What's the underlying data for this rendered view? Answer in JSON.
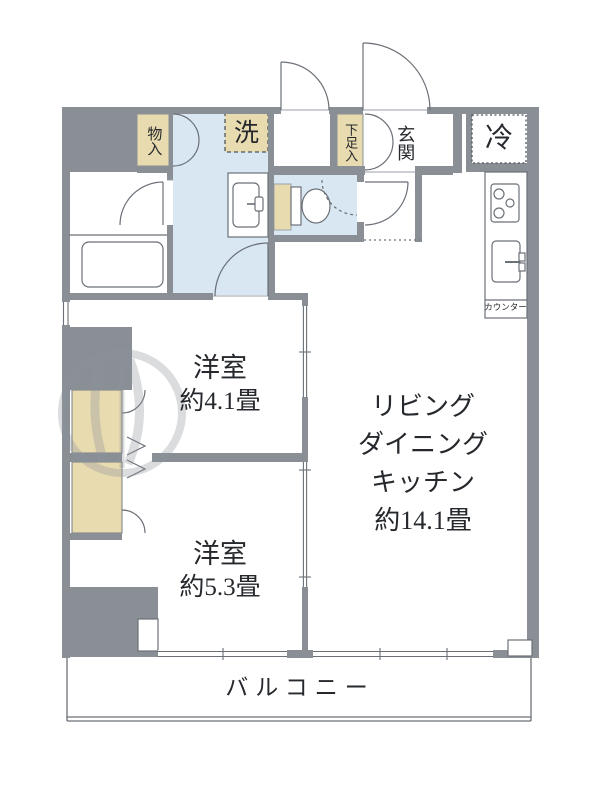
{
  "plan_title": "2LDK apartment floor plan",
  "rooms": {
    "ldk": {
      "line1": "リビング",
      "line2": "ダイニング",
      "line3": "キッチン",
      "size": "約14.1畳"
    },
    "bedroom_a": {
      "name": "洋室",
      "size": "約4.1畳"
    },
    "bedroom_b": {
      "name": "洋室",
      "size": "約5.3畳"
    },
    "balcony": {
      "name": "バルコニー"
    },
    "entrance": {
      "name": "玄関"
    }
  },
  "fixtures": {
    "storage": "物入",
    "washer": "洗",
    "shoe_storage": "下足入",
    "refrigerator": "冷",
    "counter": "カウンター"
  },
  "colors": {
    "wall_gray": "#8a8f96",
    "water_area_blue": "#d8e7f2",
    "storage_beige": "#e9dbb0",
    "line": "#5d6269",
    "text": "#25282c"
  }
}
